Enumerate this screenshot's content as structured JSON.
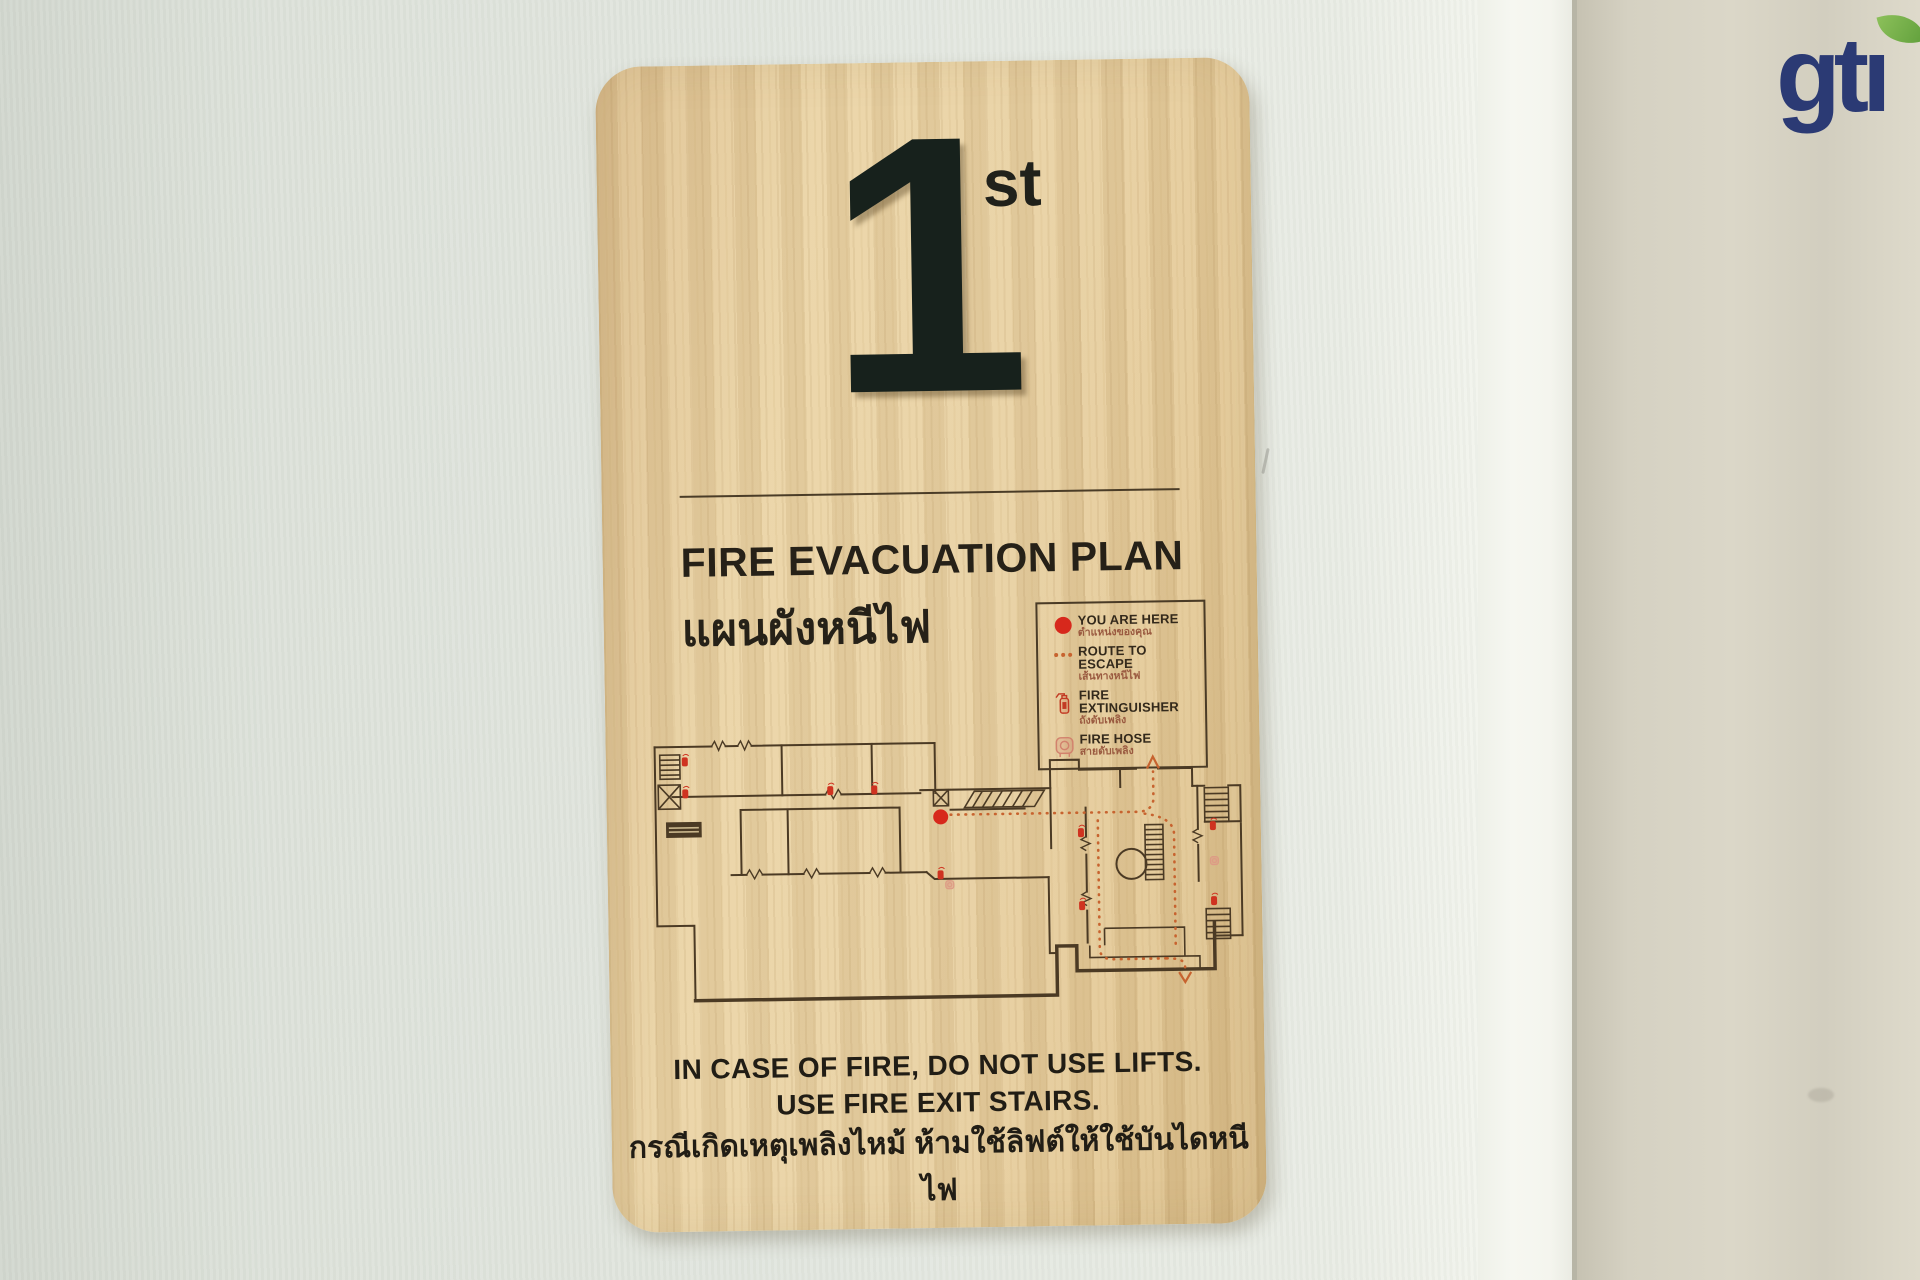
{
  "brand": {
    "text": "gti",
    "colors": {
      "blue": "#2b3a74",
      "leaf_green": "#71ab45"
    }
  },
  "sign": {
    "floor_number": "1",
    "floor_suffix": "st",
    "title_en": "FIRE EVACUATION PLAN",
    "title_th": "แผนผังหนีไฟ",
    "legend": {
      "items": [
        {
          "icon": "you-are-here-dot",
          "label_en": "YOU ARE HERE",
          "label_th": "ตำแหน่งของคุณ"
        },
        {
          "icon": "route-dotted-line",
          "label_en": "ROUTE TO ESCAPE",
          "label_th": "เส้นทางหนีไฟ"
        },
        {
          "icon": "fire-extinguisher-icon",
          "label_en": "FIRE EXTINGUISHER",
          "label_th": "ถังดับเพลิง"
        },
        {
          "icon": "fire-hose-icon",
          "label_en": "FIRE HOSE",
          "label_th": "สายดับเพลิง"
        }
      ]
    },
    "notice_line1": "IN CASE OF FIRE, DO NOT USE LIFTS.",
    "notice_line2": "USE FIRE EXIT STAIRS.",
    "notice_th": "กรณีเกิดเหตุเพลิงไหม้ ห้ามใช้ลิฟต์ให้ใช้บันไดหนีไฟ",
    "colors": {
      "wood": "#e6cfa0",
      "ink": "#262118",
      "wall_line": "#4b3a24",
      "you_are_here_red": "#d7281c",
      "route_orange": "#c7632f",
      "extinguisher_red": "#c23b24",
      "hose_pink": "#d2826d"
    }
  }
}
